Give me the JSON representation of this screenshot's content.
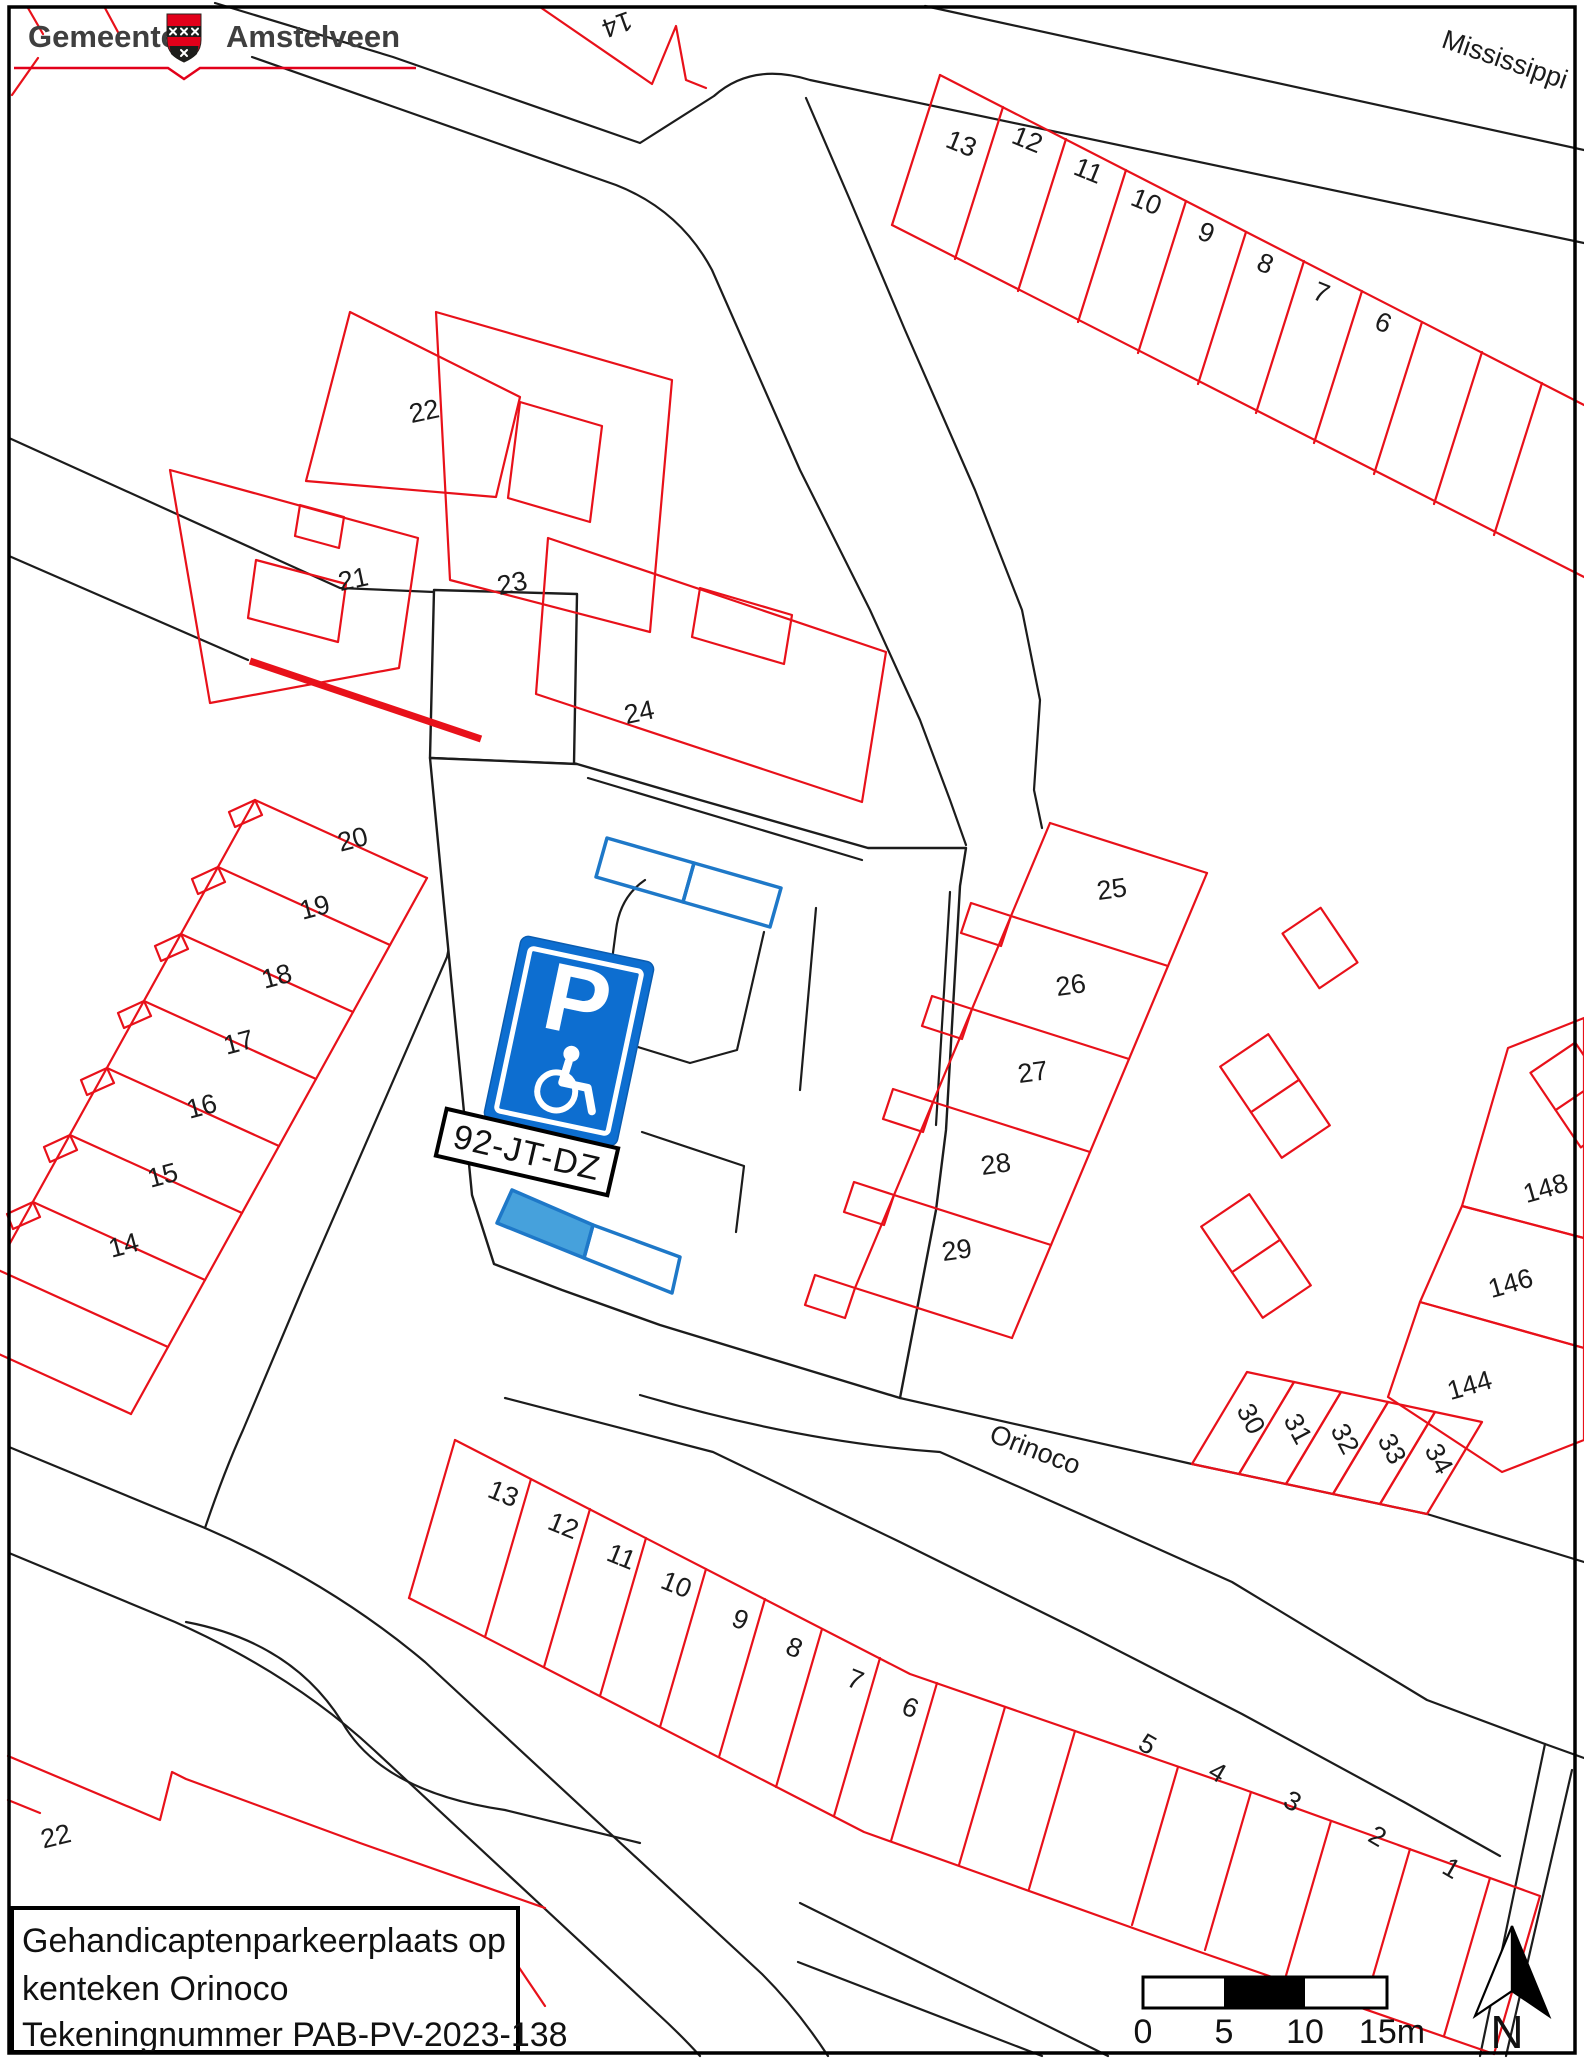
{
  "logo": {
    "left": "Gemeente",
    "right": "Amstelveen"
  },
  "infobox": {
    "lines": [
      "Gehandicaptenparkeerplaats op",
      "kenteken Orinoco",
      "Tekeningnummer PAB-PV-2023-138"
    ]
  },
  "map": {
    "streets": [
      {
        "name": "Mississippi"
      },
      {
        "name": "Orinoco"
      }
    ],
    "sign": {
      "letter": "P",
      "plate": "92-JT-DZ"
    },
    "north_label": "N",
    "scalebar": {
      "ticks": [
        "0",
        "5",
        "10",
        "15m"
      ]
    },
    "colors": {
      "parcel_red": "#e8111a",
      "line_black": "#1c1c1c",
      "sign_blue": "#0d6ed0",
      "bay_fill": "#46a1dc",
      "bay_stroke": "#1e78c8",
      "logo_red": "#e2001a"
    },
    "parcels": [
      {
        "label": "14",
        "x": 614,
        "y": 16,
        "r": 160
      },
      {
        "label": "13",
        "x": 958,
        "y": 152,
        "r": 22
      },
      {
        "label": "12",
        "x": 1024,
        "y": 148,
        "r": 22
      },
      {
        "label": "11",
        "x": 1085,
        "y": 179,
        "r": 22
      },
      {
        "label": "10",
        "x": 1143,
        "y": 210,
        "r": 22
      },
      {
        "label": "9",
        "x": 1203,
        "y": 241,
        "r": 22
      },
      {
        "label": "8",
        "x": 1262,
        "y": 272,
        "r": 22
      },
      {
        "label": "7",
        "x": 1318,
        "y": 301,
        "r": 22
      },
      {
        "label": "6",
        "x": 1380,
        "y": 331,
        "r": 22
      },
      {
        "label": "22",
        "x": 426,
        "y": 420,
        "r": -12
      },
      {
        "label": "21",
        "x": 355,
        "y": 588,
        "r": -12
      },
      {
        "label": "23",
        "x": 514,
        "y": 592,
        "r": -12
      },
      {
        "label": "24",
        "x": 641,
        "y": 721,
        "r": -12
      },
      {
        "label": "20",
        "x": 355,
        "y": 848,
        "r": -15
      },
      {
        "label": "19",
        "x": 317,
        "y": 916,
        "r": -15
      },
      {
        "label": "18",
        "x": 279,
        "y": 985,
        "r": -15
      },
      {
        "label": "17",
        "x": 241,
        "y": 1051,
        "r": -15
      },
      {
        "label": "16",
        "x": 204,
        "y": 1115,
        "r": -15
      },
      {
        "label": "15",
        "x": 165,
        "y": 1184,
        "r": -15
      },
      {
        "label": "14",
        "x": 126,
        "y": 1254,
        "r": -15
      },
      {
        "label": "25",
        "x": 1113,
        "y": 898,
        "r": -8
      },
      {
        "label": "26",
        "x": 1072,
        "y": 994,
        "r": -8
      },
      {
        "label": "27",
        "x": 1034,
        "y": 1081,
        "r": -8
      },
      {
        "label": "28",
        "x": 997,
        "y": 1173,
        "r": -8
      },
      {
        "label": "29",
        "x": 958,
        "y": 1259,
        "r": -8
      },
      {
        "label": "148",
        "x": 1548,
        "y": 1197,
        "r": -16
      },
      {
        "label": "146",
        "x": 1513,
        "y": 1292,
        "r": -16
      },
      {
        "label": "144",
        "x": 1472,
        "y": 1394,
        "r": -16
      },
      {
        "label": "30",
        "x": 1243,
        "y": 1423,
        "r": 62
      },
      {
        "label": "31",
        "x": 1290,
        "y": 1433,
        "r": 62
      },
      {
        "label": "32",
        "x": 1337,
        "y": 1443,
        "r": 62
      },
      {
        "label": "33",
        "x": 1384,
        "y": 1453,
        "r": 62
      },
      {
        "label": "34",
        "x": 1431,
        "y": 1463,
        "r": 62
      },
      {
        "label": "13",
        "x": 500,
        "y": 1502,
        "r": 22
      },
      {
        "label": "12",
        "x": 560,
        "y": 1534,
        "r": 22
      },
      {
        "label": "11",
        "x": 618,
        "y": 1565,
        "r": 22
      },
      {
        "label": "10",
        "x": 673,
        "y": 1593,
        "r": 22
      },
      {
        "label": "9",
        "x": 737,
        "y": 1628,
        "r": 22
      },
      {
        "label": "8",
        "x": 791,
        "y": 1656,
        "r": 22
      },
      {
        "label": "7",
        "x": 852,
        "y": 1688,
        "r": 22
      },
      {
        "label": "6",
        "x": 907,
        "y": 1716,
        "r": 22
      },
      {
        "label": "5",
        "x": 1143,
        "y": 1752,
        "r": 30
      },
      {
        "label": "4",
        "x": 1213,
        "y": 1780,
        "r": 30
      },
      {
        "label": "3",
        "x": 1288,
        "y": 1809,
        "r": 30
      },
      {
        "label": "2",
        "x": 1373,
        "y": 1844,
        "r": 30
      },
      {
        "label": "1",
        "x": 1447,
        "y": 1876,
        "r": 30
      },
      {
        "label": "22",
        "x": 58,
        "y": 1845,
        "r": -14
      }
    ]
  }
}
